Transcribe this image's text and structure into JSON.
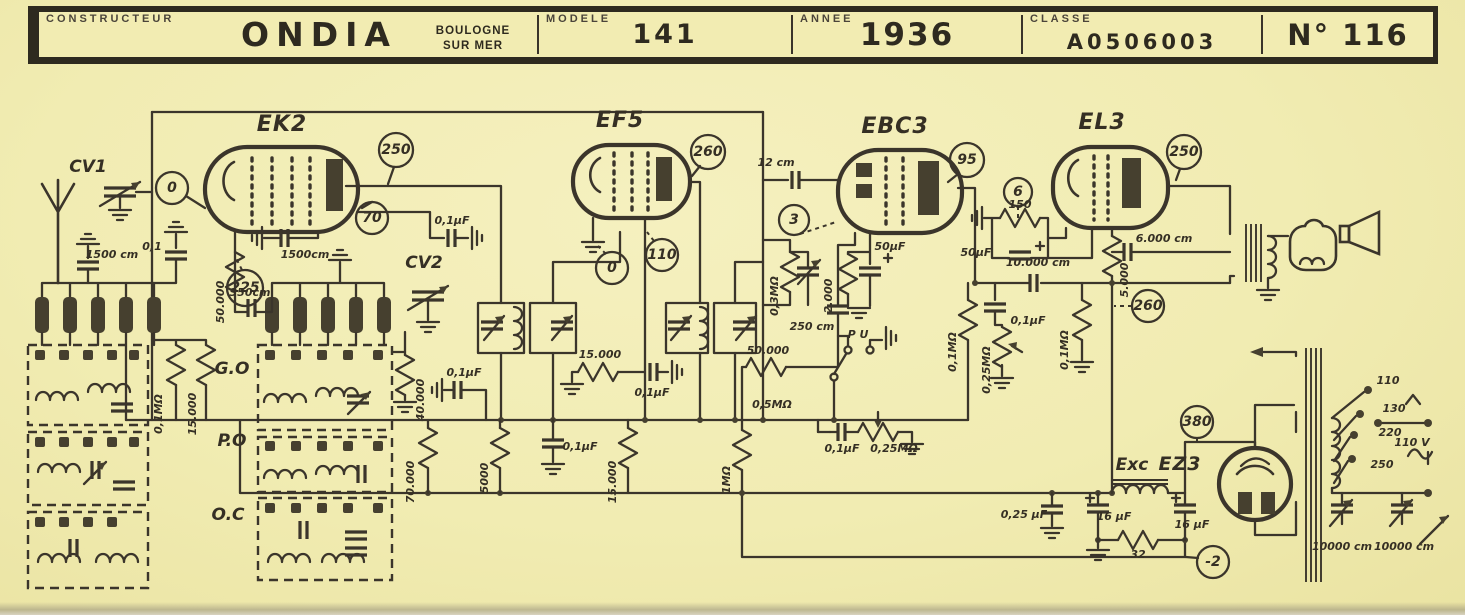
{
  "header": {
    "constructeur_label": "CONSTRUCTEUR",
    "brand": "ONDIA",
    "city_line1": "BOULOGNE",
    "city_line2": "SUR MER",
    "modele_label": "MODELE",
    "modele_value": "141",
    "annee_label": "ANNEE",
    "annee_value": "1936",
    "classe_label": "CLASSE",
    "classe_value": "A0506003",
    "numero": "N° 116"
  },
  "tubes": {
    "v1": "EK2",
    "v2": "EF5",
    "v3": "EBC3",
    "v4": "EL3",
    "v5": "EZ3"
  },
  "bands": {
    "go": "G.O",
    "po": "P.O",
    "oc": "O.C"
  },
  "test_points": {
    "ek2_grid": "0",
    "ek2_anode": "250",
    "ek2_screen": "70",
    "ek2_osc": "225",
    "ef5_anode": "260",
    "ef5_cathode": "0",
    "ef5_screen": "110",
    "ebc3_anode": "95",
    "ebc3_diode": "3",
    "el3_grid": "6",
    "el3_anode": "250",
    "el3_screen": "260",
    "rectifier_ht": "380",
    "bias": "-2"
  },
  "labels": {
    "cv1": "CV1",
    "cv2": "CV2",
    "ant_cap": "1500 cm",
    "ant_cap2": "0,1",
    "grid_leak": "50.000",
    "grid_cap": "1500cm",
    "osc_cap": "350cm",
    "sw_r1": "0,1MΩ",
    "sw_r2": "15.000",
    "screen_cap": "0,1μF",
    "agc_cap": "0,1μF",
    "r40k": "40.000",
    "if_r": "15.000",
    "if_cap": "0,1μF",
    "bus_r1": "70.000",
    "bus_r2": "5000",
    "bus_cap": "0,1μF",
    "bus_r3": "15.000",
    "det_r": "50.000",
    "det_r2": "0,5MΩ",
    "det_r3": "1MΩ",
    "det_r4": "0,3MΩ",
    "det_cap": "250 cm",
    "diode_cap": "12 cm",
    "cath_r": "2.000",
    "cath_cap": "50μF",
    "pu": "P U",
    "pu_cap": "0,1μF",
    "pu_pot": "0,25MΩ",
    "af_r": "0,1MΩ",
    "vol_pot": "0,25MΩ",
    "af_cap": "0,1μF",
    "el3_cath_r": "150",
    "el3_cath_cap": "50μF",
    "coupling_cap": "10.000 cm",
    "el3_screen_r": "5.000",
    "el3_grid_r": "0,1MΩ",
    "tone_cap": "6.000 cm",
    "exc": "Exc",
    "psu_cap1": "0,25 μF",
    "psu_cap2": "16 μF",
    "psu_cap3": "16 μF",
    "psu_r": "32",
    "tap1": "110",
    "tap2": "130",
    "tap3": "220",
    "tap4": "250",
    "outlet": "110 V",
    "mains_cap1": "10000 cm",
    "mains_cap2": "10000 cm"
  }
}
